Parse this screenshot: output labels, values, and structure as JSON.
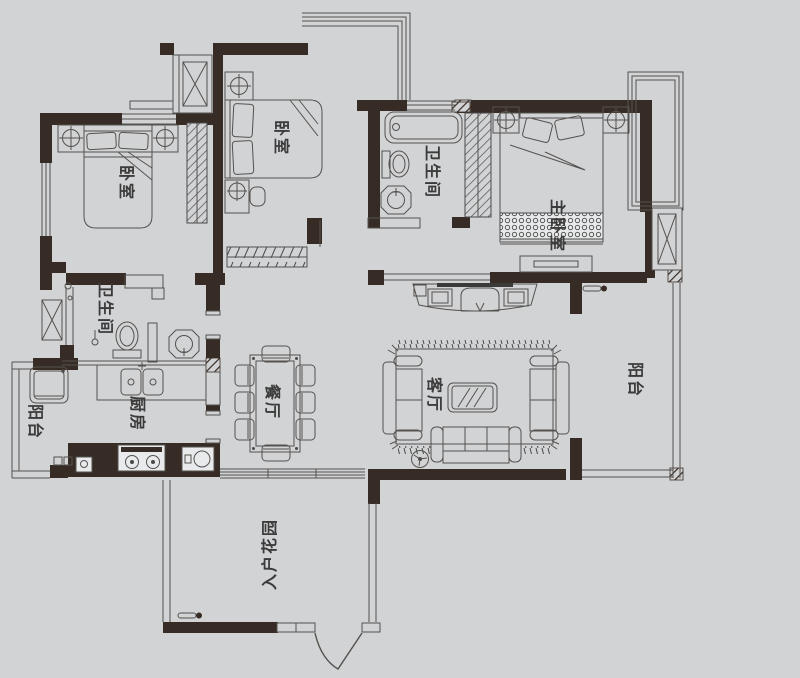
{
  "title": "residential floor plan",
  "colors": {
    "background": "#d2d3d5",
    "wall": "#362c25",
    "line": "#54524f",
    "label": "#3b3b3b"
  },
  "rooms": {
    "bedroom_left": {
      "label": "卧室"
    },
    "bedroom_middle": {
      "label": "卧室"
    },
    "bathroom_top": {
      "label": "卫生间"
    },
    "master_bedroom": {
      "label": "主卧室"
    },
    "bathroom_left": {
      "label": "卫生间"
    },
    "kitchen": {
      "label": "厨房"
    },
    "dining": {
      "label": "餐厅"
    },
    "living": {
      "label": "客厅"
    },
    "balcony_left": {
      "label": "阳台"
    },
    "balcony_right": {
      "label": "阳台"
    },
    "entry_garden": {
      "label": "入户花园"
    }
  }
}
